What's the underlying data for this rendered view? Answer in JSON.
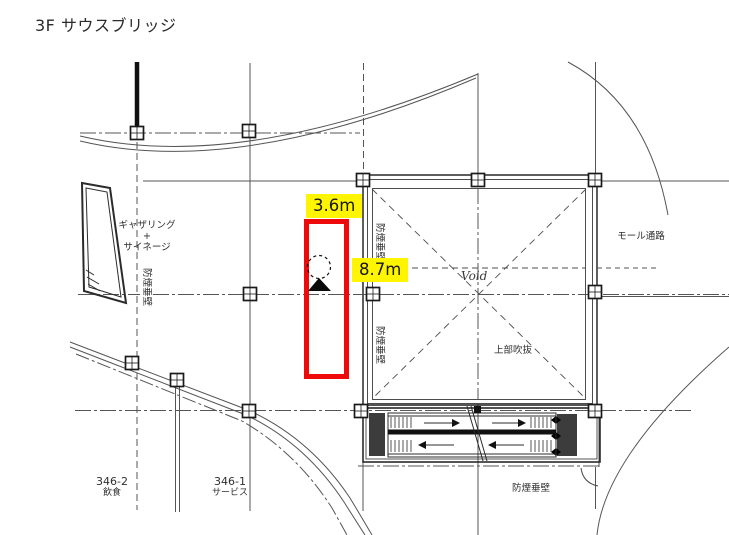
{
  "page": {
    "title": "3F  サウスブリッジ"
  },
  "measurements": {
    "width_label": "3.6m",
    "depth_label": "8.7m",
    "highlight_bg": "#fff500",
    "rect_color": "#ee0a0a"
  },
  "plan_labels": {
    "gathering_line1": "ギャザリング",
    "gathering_line2": "+",
    "gathering_line3": "サイネージ",
    "smoke_barrier": "防煙垂壁",
    "void": "Void",
    "upper_atrium": "上部吹抜",
    "mall_corridor": "モール通路",
    "tenants": [
      {
        "number": "346-2",
        "type": "飲食"
      },
      {
        "number": "346-1",
        "type": "サービス"
      }
    ]
  }
}
